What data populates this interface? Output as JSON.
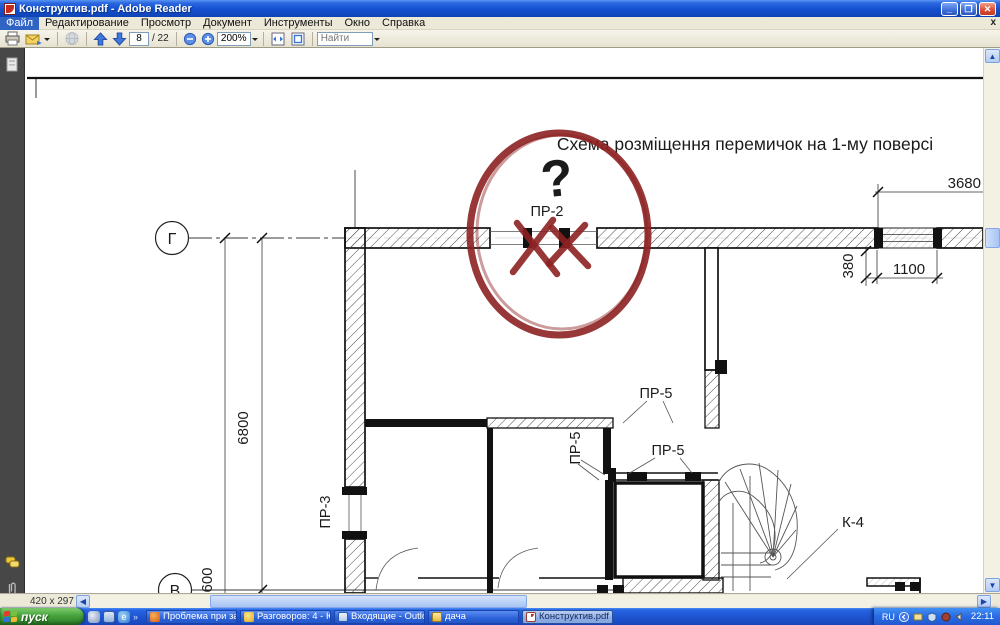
{
  "window": {
    "title": "Конструктив.pdf - Adobe Reader"
  },
  "menu": {
    "items": [
      "Файл",
      "Редактирование",
      "Просмотр",
      "Документ",
      "Инструменты",
      "Окно",
      "Справка"
    ],
    "close_button": "x"
  },
  "toolbar": {
    "page_current": "8",
    "page_total": "/ 22",
    "zoom_level": "200%",
    "find_placeholder": "Найти"
  },
  "statusbar": {
    "page_size": "420 x 297 мм"
  },
  "taskbar": {
    "start_label": "пуск",
    "quicklaunch_overflow": "»",
    "buttons": [
      {
        "label": "Проблема при загру..."
      },
      {
        "label": "Разговоров: 4 - Юля..."
      },
      {
        "label": "Входящие - Outlook ..."
      },
      {
        "label": "дача"
      },
      {
        "label": "Конструктив.pdf - A..."
      }
    ],
    "tray": {
      "language": "RU",
      "clock": "22:11"
    }
  },
  "drawing": {
    "title": "Схема розміщення перемичок на 1-му поверсі",
    "axis_labels": {
      "top": "Г",
      "bottom": "В"
    },
    "dimensions": {
      "top_width": "3680",
      "wall_offset": "380",
      "window_width": "1100",
      "left_height": "6800",
      "bottom_offset": "600"
    },
    "lintel_labels": {
      "pr2": "ПР-2",
      "pr3": "ПР-3",
      "pr5": "ПР-5"
    },
    "stair_label": "К-4",
    "annotation": {
      "question_mark": "?",
      "marker_color": "#8d2121"
    }
  }
}
